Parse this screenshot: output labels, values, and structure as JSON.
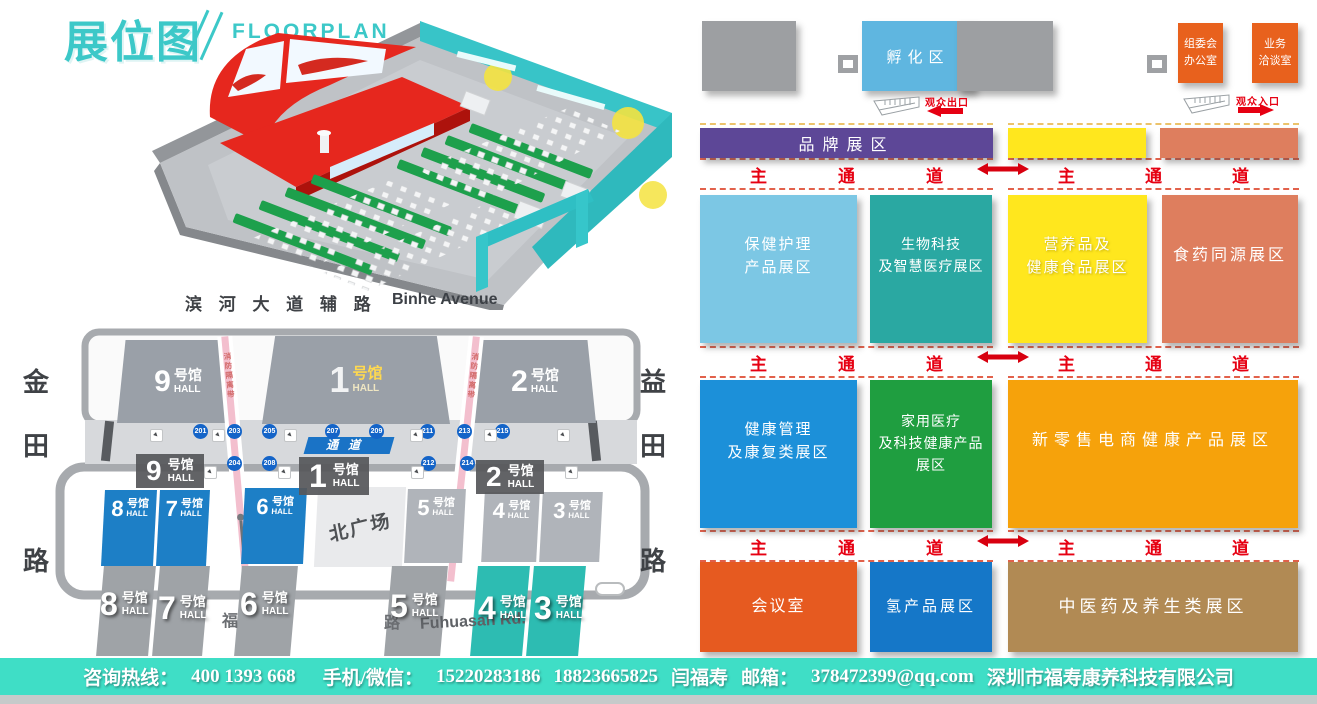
{
  "header": {
    "title_cn": "展位图",
    "title_en": "FLOORPLAN"
  },
  "colors": {
    "accent_teal": "#3cc8c8",
    "footer_teal": "#3fdec6",
    "aisle_red": "#e60012",
    "incubation_blue": "#5fb6e0",
    "office_orange": "#e8611d",
    "brand_purple": "#5d4797",
    "bar_yellow": "#ffe71e",
    "bar_salmon": "#de7e5e",
    "map_hall_blue": "#1d7fc6",
    "map_strip_teal": "#2dbcb2",
    "badge_blue": "#1464c8",
    "block_gray": "#9d9fa2"
  },
  "map": {
    "road_top_cn": "滨 河 大 道 辅 路",
    "road_top_en": "Binhe Avenue",
    "road_left_chars": [
      "金",
      "田",
      "路"
    ],
    "road_right_chars": [
      "益",
      "田",
      "路"
    ],
    "road_bottom_cn_a": "福",
    "road_bottom_cn_b": "路",
    "road_bottom_en": "Fuhuasan Rd.",
    "plaza": "北广场",
    "fire_lane": "消防隔离带",
    "corridor_label": "通道",
    "suffix": "号馆",
    "hall_en": "HALL",
    "top_halls": [
      "9",
      "1",
      "2"
    ],
    "bottom_halls": [
      "8",
      "7",
      "6",
      "5",
      "4",
      "3"
    ],
    "strip_halls": [
      "8",
      "7",
      "6",
      "5",
      "4",
      "3"
    ],
    "overlay_halls": [
      "9",
      "1",
      "2"
    ],
    "badges_top": [
      "201",
      "203",
      "205",
      "207",
      "209",
      "211",
      "213",
      "215"
    ],
    "badges_bottom": [
      "204",
      "208",
      "212",
      "214"
    ]
  },
  "panel": {
    "incubation": "孵化区",
    "office1_l1": "组委会",
    "office1_l2": "办公室",
    "office2_l1": "业务",
    "office2_l2": "洽谈室",
    "exit_label": "观众出口",
    "entrance_label": "观众入口",
    "brand_bar": "品牌展区",
    "aisle_chars": [
      "主",
      "通",
      "道"
    ],
    "zones_row1": [
      {
        "l1": "保健护理",
        "l2": "产品展区",
        "color": "#7cc7e4"
      },
      {
        "l1": "生物科技",
        "l2": "及智慧医疗展区",
        "color": "#2aa8a2"
      },
      {
        "l1": "营养品及",
        "l2": "健康食品展区",
        "color": "#ffe71e"
      },
      {
        "l1": "食药同源展区",
        "l2": "",
        "color": "#de7e5e"
      }
    ],
    "zones_row2": [
      {
        "l1": "健康管理",
        "l2": "及康复类展区",
        "color": "#1c90d9"
      },
      {
        "l1": "家用医疗",
        "l2": "及科技健康产品",
        "l3": "展区",
        "color": "#1f9e40"
      },
      {
        "l1": "新零售电商健康产品展区",
        "l2": "",
        "color": "#f6a20b"
      }
    ],
    "zones_row3": [
      {
        "l1": "会议室",
        "color": "#e65a20"
      },
      {
        "l1": "氢产品展区",
        "color": "#1577c8"
      },
      {
        "l1": "中医药及养生类展区",
        "color": "#b18a54"
      }
    ]
  },
  "footer": {
    "hotline_label": "咨询热线：",
    "hotline": "400 1393 668",
    "wechat_label": "手机/微信：",
    "phone1": "15220283186",
    "phone2": "18823665825",
    "contact_name": "闫福寿",
    "email_label": "邮箱：",
    "email": "378472399@qq.com",
    "company": "深圳市福寿康养科技有限公司"
  }
}
